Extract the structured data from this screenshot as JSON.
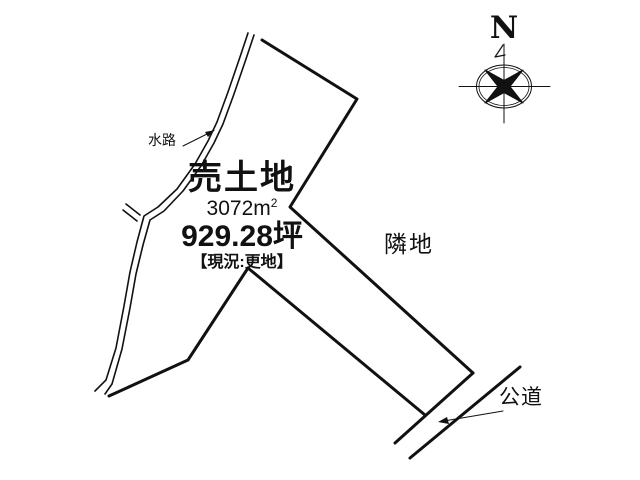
{
  "diagram": {
    "background_color": "#ffffff",
    "ink_color": "#111111"
  },
  "compass": {
    "north_label": "N"
  },
  "listing": {
    "title": "売土地",
    "area_value": "3072",
    "area_unit": "m",
    "area_sup": "2",
    "tsubo": "929.28坪",
    "status": "【現況:更地】"
  },
  "labels": {
    "waterway": "水路",
    "neighbor": "隣地",
    "road": "公道"
  }
}
